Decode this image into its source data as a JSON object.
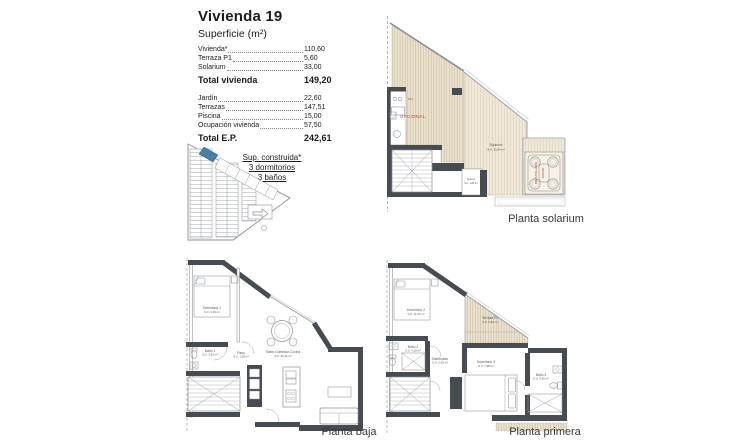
{
  "info_panel": {
    "title": "Vivienda 19",
    "subtitle": "Superficie (m²)",
    "surface_rows": [
      {
        "label": "Vivienda*",
        "value": "110,60"
      },
      {
        "label": "Terraza P1",
        "value": "5,60"
      },
      {
        "label": "Solarium",
        "value": "33,00"
      }
    ],
    "surface_total": {
      "label": "Total vivienda",
      "value": "149,20"
    },
    "exterior_rows": [
      {
        "label": "Jardín",
        "value": "22,60"
      },
      {
        "label": "Terrazas",
        "value": "147,51"
      },
      {
        "label": "Piscina",
        "value": "15,00"
      },
      {
        "label": "Ocupación vivienda",
        "value": "57,50"
      }
    ],
    "exterior_total": {
      "label": "Total E.P.",
      "value": "242,61"
    },
    "built_note": {
      "line1": "Sup. construida*",
      "line2": "3 dormitorios",
      "line3": "3 baños"
    }
  },
  "captions": {
    "solarium": "Planta solarium",
    "baja": "Planta baja",
    "primera": "Planta primera"
  },
  "solarium_plan": {
    "opcional_label": "OPCIONAL",
    "room_label": "Solarium",
    "room_area": "S.U. 33,00 m²",
    "hueco_label": "Hueco",
    "hueco_area": "S.U. 1,80 m²",
    "jacuzzi_label_1": "PREINSTALACIÓN",
    "jacuzzi_label_2": "JACUZZI",
    "bbq_label": "BBQ"
  },
  "baja_plan": {
    "dormitorio1": {
      "name": "Dormitorio 1",
      "area": "S.U. 9,29 m²"
    },
    "bano1": {
      "name": "Baño 1",
      "area": "S.U. 3,52 m²"
    },
    "paso": {
      "name": "Paso",
      "area": "S.U. 1,28 m²"
    },
    "salon": {
      "name": "Salón-Comedor-Cocina",
      "area": "S.U. 23,41 m²"
    }
  },
  "primera_plan": {
    "dormitorio2": {
      "name": "Dormitorio 2",
      "area": "S.U. 11,63 m²"
    },
    "bano2": {
      "name": "Baño 2",
      "area": "S.U. 4,20 m²"
    },
    "distribuidor": {
      "name": "Distribuidor",
      "area": "S.U. 2,63 m²"
    },
    "dormitorio3": {
      "name": "Dormitorio 3",
      "area": "S.U. 7,98 m²"
    },
    "bano3": {
      "name": "Baño 3",
      "area": "S.U. 5,40 m²"
    },
    "terraza": {
      "name": "Terraza P1",
      "area": "S.U. 5,60 m²"
    }
  },
  "colors": {
    "wall": "#474c52",
    "hatch_bg": "#ece4d3",
    "hatch_line": "#c6b896",
    "accent_red": "#b03a30",
    "plot_blue": "#4a7fa5"
  }
}
